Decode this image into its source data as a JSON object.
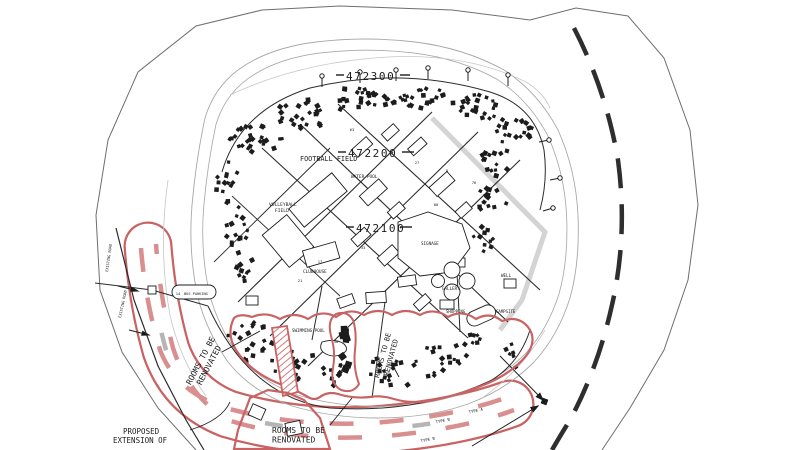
{
  "drawing": {
    "type": "site-plan",
    "colors": {
      "ink": "#1c1c1c",
      "road": "#2b2b2b",
      "contour": "#a8a8a8",
      "contour_light": "#c6c6c6",
      "boundary": "#6e6e6e",
      "red": "#c96262",
      "red_dash": "#d98f8f",
      "gray_dash": "#b5b5b5",
      "background": "#ffffff"
    },
    "grid_labels": [
      {
        "text": "472300",
        "x": 346,
        "y": 80
      },
      {
        "text": "472200",
        "x": 348,
        "y": 157
      },
      {
        "text": "472100",
        "x": 356,
        "y": 232
      }
    ],
    "place_labels": [
      {
        "text": "FOOTBALL FIELD",
        "x": 300,
        "y": 161,
        "size": 6.8
      },
      {
        "text": "VOLLEYBALL",
        "x": 269,
        "y": 206,
        "size": 4.6
      },
      {
        "text": "FIELD",
        "x": 275,
        "y": 212,
        "size": 4.6
      },
      {
        "text": "WATER POOL",
        "x": 351,
        "y": 178,
        "size": 4.4
      },
      {
        "text": "CLUBHOUSE",
        "x": 303,
        "y": 273,
        "size": 4.4
      },
      {
        "text": "SIGNAGE",
        "x": 421,
        "y": 245,
        "size": 4.2
      },
      {
        "text": "GALLERY",
        "x": 442,
        "y": 290,
        "size": 4.2
      },
      {
        "text": "WELL",
        "x": 501,
        "y": 277,
        "size": 4.2
      },
      {
        "text": "BUS PARKING",
        "x": 184,
        "y": 295,
        "size": 3.6
      },
      {
        "text": "SWIMMING POOL",
        "x": 292,
        "y": 332,
        "size": 4.2
      },
      {
        "text": "SHOPPING",
        "x": 446,
        "y": 313,
        "size": 4.0
      },
      {
        "text": "CAMPSITE",
        "x": 496,
        "y": 313,
        "size": 4.0
      }
    ],
    "annotation_labels": {
      "renovated_left": {
        "line1": "ROOMS TO BE",
        "line2": "RENOVATED",
        "x": 203,
        "y": 362,
        "rotate": -62,
        "size": 8
      },
      "renovated_right": {
        "line1": "ROOMS TO BE",
        "line2": "RENOVATED",
        "x": 385,
        "y": 356,
        "rotate": -75,
        "size": 7
      },
      "renovated_bottom": {
        "line1": "ROOMS TO BE",
        "line2": "RENOVATED",
        "x": 272,
        "y": 433,
        "size": 8
      },
      "proposed": {
        "line1": "PROPOSED",
        "line2": "EXTENSION OF",
        "x": 113,
        "y": 434,
        "dx1": 10,
        "size": 7.5
      },
      "existing_road_1": {
        "text": "EXISTING ROAD",
        "x": 108,
        "y": 272,
        "rotate": -82,
        "size": 3.6
      },
      "existing_road_2": {
        "text": "EXISTING ROAD",
        "x": 121,
        "y": 318,
        "rotate": -78,
        "size": 3.6
      },
      "type_labels": [
        {
          "text": "TYPE B",
          "x": 443,
          "y": 422,
          "rotate": -12
        },
        {
          "text": "TYPE A",
          "x": 476,
          "y": 412,
          "rotate": -12
        },
        {
          "text": "TYPE B",
          "x": 428,
          "y": 441,
          "rotate": -12
        }
      ]
    },
    "lot_numbers": [
      {
        "n": "17",
        "x": 320,
        "y": 263
      },
      {
        "n": "14",
        "x": 178,
        "y": 295
      },
      {
        "n": "27",
        "x": 417,
        "y": 164
      },
      {
        "n": "76",
        "x": 474,
        "y": 184
      },
      {
        "n": "63",
        "x": 352,
        "y": 131
      },
      {
        "n": "80",
        "x": 436,
        "y": 206
      },
      {
        "n": "50",
        "x": 336,
        "y": 343
      },
      {
        "n": "33",
        "x": 363,
        "y": 249
      },
      {
        "n": "21",
        "x": 300,
        "y": 282
      },
      {
        "n": "8",
        "x": 447,
        "y": 172
      }
    ],
    "building_clusters": [
      {
        "cx": 255,
        "cy": 138,
        "rx": 28,
        "ry": 17,
        "n": 26
      },
      {
        "cx": 306,
        "cy": 114,
        "rx": 30,
        "ry": 15,
        "n": 26
      },
      {
        "cx": 360,
        "cy": 100,
        "rx": 30,
        "ry": 13,
        "n": 26
      },
      {
        "cx": 420,
        "cy": 97,
        "rx": 30,
        "ry": 13,
        "n": 24
      },
      {
        "cx": 474,
        "cy": 108,
        "rx": 26,
        "ry": 14,
        "n": 22
      },
      {
        "cx": 514,
        "cy": 130,
        "rx": 20,
        "ry": 15,
        "n": 18
      },
      {
        "cx": 228,
        "cy": 182,
        "rx": 13,
        "ry": 21,
        "n": 14
      },
      {
        "cx": 236,
        "cy": 226,
        "rx": 12,
        "ry": 23,
        "n": 14
      },
      {
        "cx": 243,
        "cy": 266,
        "rx": 10,
        "ry": 16,
        "n": 10
      },
      {
        "cx": 497,
        "cy": 160,
        "rx": 16,
        "ry": 16,
        "n": 14
      },
      {
        "cx": 492,
        "cy": 200,
        "rx": 15,
        "ry": 18,
        "n": 14
      },
      {
        "cx": 483,
        "cy": 238,
        "rx": 13,
        "ry": 14,
        "n": 10
      },
      {
        "cx": 252,
        "cy": 342,
        "rx": 25,
        "ry": 21,
        "n": 20
      },
      {
        "cx": 294,
        "cy": 362,
        "rx": 23,
        "ry": 19,
        "n": 18
      },
      {
        "cx": 330,
        "cy": 374,
        "rx": 15,
        "ry": 13,
        "n": 10
      },
      {
        "cx": 392,
        "cy": 372,
        "rx": 25,
        "ry": 17,
        "n": 18
      },
      {
        "cx": 438,
        "cy": 362,
        "rx": 22,
        "ry": 17,
        "n": 16
      },
      {
        "cx": 470,
        "cy": 344,
        "rx": 15,
        "ry": 13,
        "n": 9
      },
      {
        "cx": 345,
        "cy": 348,
        "rx": 5,
        "ry": 26,
        "n": 8,
        "s": 6
      },
      {
        "cx": 512,
        "cy": 358,
        "rx": 9,
        "ry": 16,
        "n": 6
      }
    ],
    "poles": [
      {
        "x": 322,
        "y": 76,
        "dx": 0,
        "dy": 11
      },
      {
        "x": 360,
        "y": 72,
        "dx": 0,
        "dy": 11
      },
      {
        "x": 396,
        "y": 70,
        "dx": 0,
        "dy": 11
      },
      {
        "x": 428,
        "y": 68,
        "dx": 0,
        "dy": 11
      },
      {
        "x": 468,
        "y": 70,
        "dx": 0,
        "dy": 11
      },
      {
        "x": 508,
        "y": 75,
        "dx": 0,
        "dy": 11
      },
      {
        "x": 549,
        "y": 140,
        "dx": -10,
        "dy": 2
      },
      {
        "x": 560,
        "y": 178,
        "dx": -10,
        "dy": 2
      },
      {
        "x": 553,
        "y": 208,
        "dx": -10,
        "dy": 3
      }
    ]
  }
}
